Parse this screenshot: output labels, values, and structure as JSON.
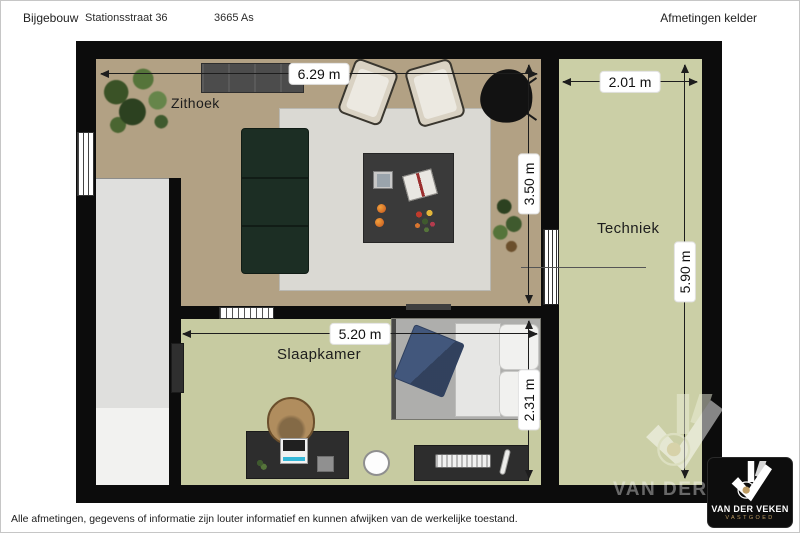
{
  "header": {
    "project": "Bijgebouw",
    "address": "Stationsstraat 36",
    "postal_city": "3665 As",
    "plan_title": "Afmetingen kelder"
  },
  "rooms": {
    "living": {
      "label": "Zithoek",
      "width": "6.29 m",
      "depth": "3.50 m"
    },
    "tech": {
      "label": "Techniek",
      "width": "2.01 m",
      "depth": "5.90 m"
    },
    "bedroom": {
      "label": "Slaapkamer",
      "width": "5.20 m",
      "depth": "2.31 m"
    }
  },
  "footer": {
    "disclaimer": "Alle afmetingen, gegevens of informatie zijn louter informatief en kunnen afwijken van de werkelijke toestand."
  },
  "branding": {
    "watermark_text": "VAN DER VEKEN",
    "logo_title": "VAN DER VEKEN",
    "logo_subtitle": "VASTGOED"
  },
  "colors": {
    "wall": "#0c0c0c",
    "floor_living": "#b2a184",
    "floor_green": "#c9cda4",
    "rug": "#dad9d3",
    "sofa_green": "#1c2e24",
    "blanket_blue": "#42577c",
    "brand_gold": "#bf9d64"
  }
}
